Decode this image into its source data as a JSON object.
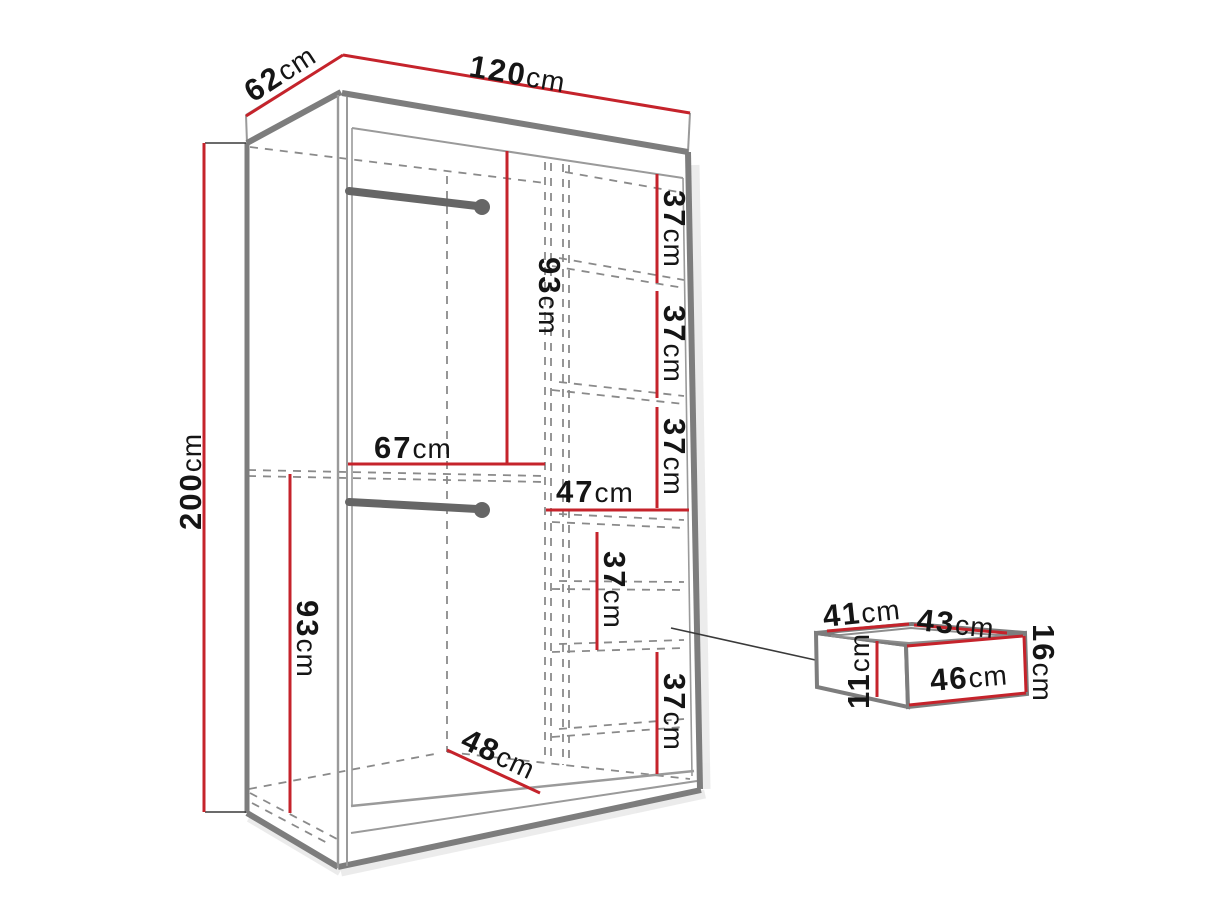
{
  "dimensions": {
    "depth": {
      "value": "62",
      "unit": "cm"
    },
    "width": {
      "value": "120",
      "unit": "cm"
    },
    "height": {
      "value": "200",
      "unit": "cm"
    },
    "upper_section_height": {
      "value": "93",
      "unit": "cm"
    },
    "lower_section_height": {
      "value": "93",
      "unit": "cm"
    },
    "left_section_width": {
      "value": "67",
      "unit": "cm"
    },
    "right_section_width": {
      "value": "47",
      "unit": "cm"
    },
    "interior_depth": {
      "value": "48",
      "unit": "cm"
    },
    "shelf_gaps": [
      {
        "value": "37",
        "unit": "cm"
      },
      {
        "value": "37",
        "unit": "cm"
      },
      {
        "value": "37",
        "unit": "cm"
      },
      {
        "value": "37",
        "unit": "cm"
      },
      {
        "value": "37",
        "unit": "cm"
      }
    ]
  },
  "drawer": {
    "inner_depth": {
      "value": "41",
      "unit": "cm"
    },
    "inner_width": {
      "value": "43",
      "unit": "cm"
    },
    "side_height": {
      "value": "11",
      "unit": "cm"
    },
    "front_height": {
      "value": "16",
      "unit": "cm"
    },
    "front_width": {
      "value": "46",
      "unit": "cm"
    }
  },
  "colors": {
    "dimension_line": "#c5232b",
    "outline": "#7d7d7d",
    "text": "#151515"
  }
}
